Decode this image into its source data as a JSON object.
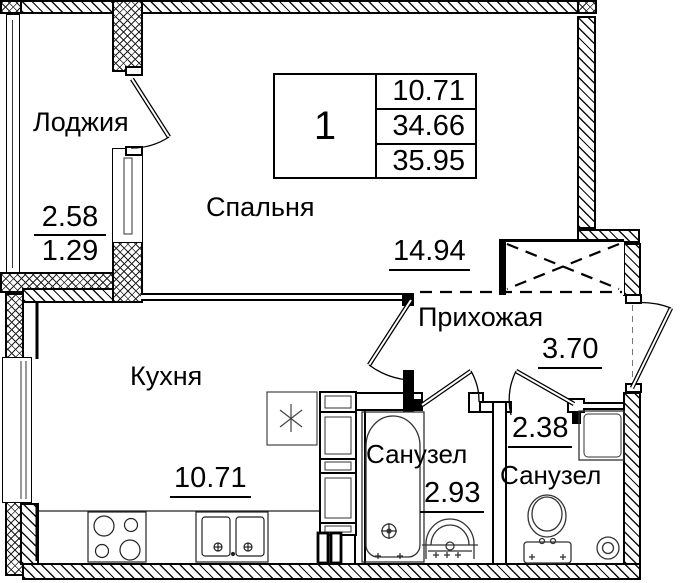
{
  "plan": {
    "legend": {
      "unit_number": "1",
      "values": [
        "10.71",
        "34.66",
        "35.95"
      ]
    },
    "rooms": {
      "loggia": {
        "label": "Лоджия",
        "area_full": "2.58",
        "area_reduced": "1.29"
      },
      "bedroom": {
        "label": "Спальня",
        "area": "14.94"
      },
      "hallway": {
        "label": "Прихожая",
        "area": "3.70"
      },
      "kitchen": {
        "label": "Кухня",
        "area": "10.71"
      },
      "bathroom_1": {
        "label": "Санузел",
        "area": "2.93"
      },
      "bathroom_2": {
        "label": "Санузел",
        "area": "2.38"
      }
    },
    "fixtures": {
      "kitchen": [
        "stove",
        "sink",
        "vent-shaft",
        "cabinet-column",
        "riser-pipes"
      ],
      "bathroom_1": [
        "bathtub",
        "washbasin"
      ],
      "bathroom_2": [
        "toilet",
        "washing-machine",
        "floor-drain"
      ],
      "hallway": [
        "wardrobe-niche"
      ]
    },
    "colors": {
      "line": "#000000",
      "background": "#ffffff"
    }
  }
}
